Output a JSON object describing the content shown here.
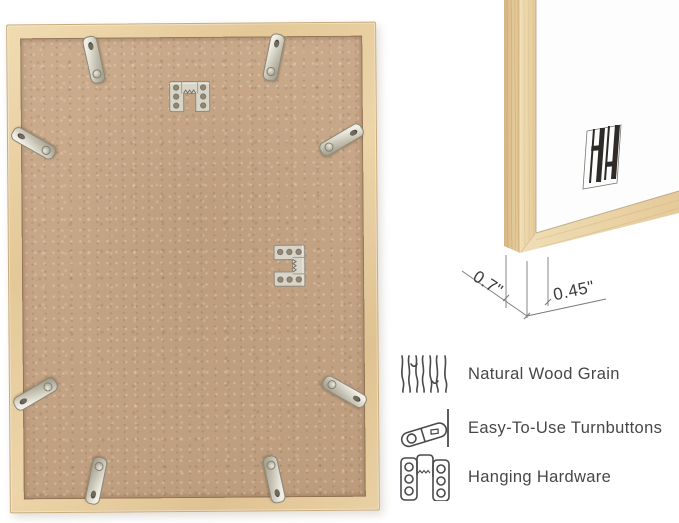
{
  "corner_detail": {
    "depth_measurement": "0.7\"",
    "face_width_measurement": "0.45\"",
    "logo": "bar-logo-mark"
  },
  "features": [
    {
      "icon": "wood-grain-icon",
      "label": "Natural Wood Grain"
    },
    {
      "icon": "turnbutton-icon",
      "label": "Easy-To-Use Turnbuttons"
    },
    {
      "icon": "hanging-hardware-icon",
      "label": "Hanging Hardware"
    }
  ],
  "frame_back": {
    "turnbutton_count": 8,
    "sawtooth_hanger_count": 2
  },
  "colors": {
    "background": "#ffffff",
    "wood_light": "#eedcb4",
    "wood_mid": "#dfc394",
    "backing": "#c6a585",
    "metal": "#d7d3c7",
    "dimension_line": "#7a7a7a",
    "text": "#474747",
    "logo_dark": "#2e2b28"
  }
}
